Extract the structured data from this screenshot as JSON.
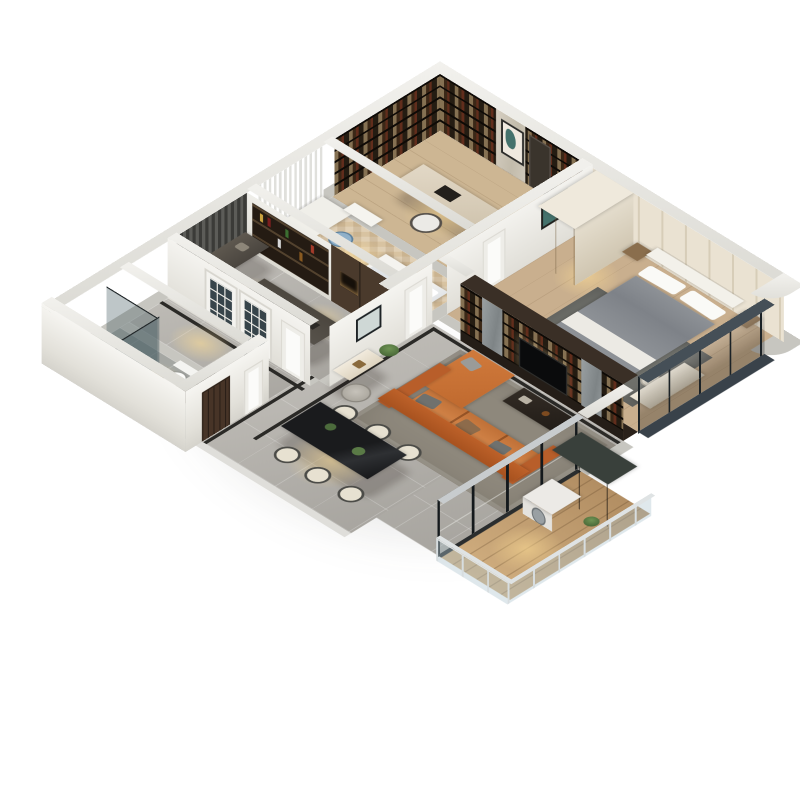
{
  "title": "3D Isometric Apartment Floor Plan Rendering",
  "scene": {
    "type": "3d-isometric-cutaway-floor-plan",
    "background": "#ffffff",
    "rooms": [
      {
        "name": "Study",
        "floor": "light wood",
        "furniture": [
          "floor-to-ceiling bookshelves",
          "marble wall panel with botanical art",
          "desk",
          "white office chair"
        ]
      },
      {
        "name": "Master Bedroom",
        "floor": "wood",
        "furniture": [
          "double bed with gray duvet",
          "white headboard",
          "padded panel wall",
          "cream wardrobe",
          "nightstands",
          "foot bench",
          "dresser with stool",
          "dark area rug",
          "curved bay window"
        ]
      },
      {
        "name": "Second Bedroom",
        "floor": "herringbone wood",
        "furniture": [
          "single bed with white bedding",
          "study desk",
          "blue chair",
          "white shelving unit",
          "sheer white curtains"
        ]
      },
      {
        "name": "Kitchen",
        "floor": "gray marble tile",
        "furniture": [
          "graphite counters",
          "bar shelves with bottles",
          "tall brown cabinets",
          "island with sink",
          "dark window curtains",
          "french doors"
        ]
      },
      {
        "name": "Hallway",
        "floor": "gray marble tile with black inlay strips",
        "furniture": [
          "console cabinet",
          "framed wall art",
          "potted plant",
          "white interior doors"
        ]
      },
      {
        "name": "Bathroom",
        "floor": "gray tile",
        "furniture": [
          "glass shower enclosure",
          "toilet",
          "dark vanity with basin"
        ]
      },
      {
        "name": "Living Room",
        "floor": "gray marble tile",
        "furniture": [
          "orange leather L-sectional sofa",
          "gray-brown cushions",
          "dark coffee table",
          "gray area rug",
          "tripod floor lamp",
          "dark wood TV media wall with shelving and marble pillars"
        ]
      },
      {
        "name": "Dining Area",
        "floor": "gray marble tile",
        "furniture": [
          "black stone dining table",
          "six cream upholstered chairs",
          "green table plants"
        ]
      },
      {
        "name": "Balcony",
        "floor": "wood planks",
        "furniture": [
          "white washing machine",
          "dark storage cabinet",
          "glass railing",
          "black-framed sliding glass doors"
        ]
      }
    ],
    "exterior": {
      "walls": "white cutaway walls",
      "entry_door": "dark walnut front door",
      "bay_window": "curved black-framed glass at right corner"
    }
  },
  "palette": {
    "wall": "#e9e8e3",
    "wallbase": "#c7c6c0",
    "marble": "#b6b3ad",
    "tile": "#a5a7a3",
    "wood": "#cdb693",
    "wood2": "#c9af8e",
    "herring": "#d8c3a1",
    "plank": "#c19a6b",
    "darkwood": "#392f26",
    "shelf": "#221a12",
    "sofa": "#c66a2f",
    "sofa_seat": "#d07a3c",
    "rug_living": "#8e887c",
    "rug_bed": "#6f706b",
    "duvet": "#83878d",
    "glass": "#36444c",
    "teal_art": "#44726c",
    "gold": "#c9a23f",
    "plant": "#4c6b3c",
    "black_table": "#141517"
  }
}
